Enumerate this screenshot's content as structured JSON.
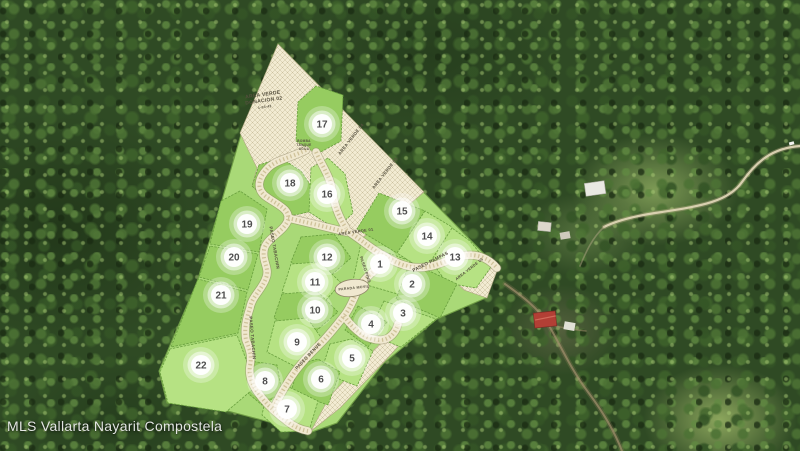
{
  "watermark": {
    "text": "MLS Vallarta Nayarit Compostela"
  },
  "map": {
    "description": "aerial-photo-with-subdivision-plat-overlay",
    "palette": {
      "lot_light": "#b6e283",
      "lot_dark": "#96cc60",
      "lot_stroke": "#69a03e",
      "hatch_cream": "#f2ebd2",
      "road_fill": "#f0e8cf",
      "road_edge": "#8f8668",
      "marker_white": "#ffffff",
      "number_gray": "#4e4e4e",
      "label_brown": "#55503e",
      "forest_green": "#2f4a24"
    },
    "lots": [
      {
        "number": "1",
        "x": 380,
        "y": 264
      },
      {
        "number": "2",
        "x": 412,
        "y": 284
      },
      {
        "number": "3",
        "x": 403,
        "y": 313
      },
      {
        "number": "4",
        "x": 371,
        "y": 324
      },
      {
        "number": "5",
        "x": 352,
        "y": 358
      },
      {
        "number": "6",
        "x": 321,
        "y": 379
      },
      {
        "number": "7",
        "x": 287,
        "y": 409
      },
      {
        "number": "8",
        "x": 265,
        "y": 381
      },
      {
        "number": "9",
        "x": 297,
        "y": 342
      },
      {
        "number": "10",
        "x": 315,
        "y": 310
      },
      {
        "number": "11",
        "x": 315,
        "y": 282
      },
      {
        "number": "12",
        "x": 327,
        "y": 257
      },
      {
        "number": "13",
        "x": 455,
        "y": 257
      },
      {
        "number": "14",
        "x": 427,
        "y": 236
      },
      {
        "number": "15",
        "x": 402,
        "y": 211
      },
      {
        "number": "16",
        "x": 327,
        "y": 194
      },
      {
        "number": "17",
        "x": 322,
        "y": 124
      },
      {
        "number": "18",
        "x": 290,
        "y": 183
      },
      {
        "number": "19",
        "x": 247,
        "y": 224
      },
      {
        "number": "20",
        "x": 234,
        "y": 257
      },
      {
        "number": "21",
        "x": 221,
        "y": 295
      },
      {
        "number": "22",
        "x": 201,
        "y": 365
      }
    ],
    "labels": [
      {
        "text": "AREA VERDE",
        "x": 263,
        "y": 96,
        "rotate": -8,
        "size": 5
      },
      {
        "text": "DONACION 02",
        "x": 264,
        "y": 102,
        "rotate": -8,
        "size": 5
      },
      {
        "text": "1-03-42",
        "x": 265,
        "y": 108,
        "rotate": -8,
        "size": 3.4
      },
      {
        "text": "AREA VERDE 04",
        "x": 352,
        "y": 140,
        "rotate": -52,
        "size": 4.4
      },
      {
        "text": "AREA VERDE 03",
        "x": 386,
        "y": 174,
        "rotate": -52,
        "size": 4.4
      },
      {
        "text": "AREA VERDE 01",
        "x": 356,
        "y": 233,
        "rotate": -8,
        "size": 4
      },
      {
        "text": "AREA VERDE 05",
        "x": 470,
        "y": 270,
        "rotate": -38,
        "size": 3.8
      },
      {
        "text": "PASEO PAMPAS",
        "x": 431,
        "y": 263,
        "rotate": -27,
        "size": 4.6
      },
      {
        "text": "PASEO TABACHIN",
        "x": 273,
        "y": 248,
        "rotate": 80,
        "size": 4.4
      },
      {
        "text": "PASEO TABACHIN",
        "x": 251,
        "y": 338,
        "rotate": 85,
        "size": 4.4
      },
      {
        "text": "PASEO BENUE",
        "x": 309,
        "y": 357,
        "rotate": -47,
        "size": 4.4
      },
      {
        "text": "PASEO PINO",
        "x": 364,
        "y": 270,
        "rotate": 72,
        "size": 4
      },
      {
        "text": "PARADA MOVIL",
        "x": 354,
        "y": 289,
        "rotate": -6,
        "size": 3.6
      },
      {
        "text": "BOMBA",
        "x": 304,
        "y": 142,
        "rotate": 0,
        "size": 3.2
      },
      {
        "text": "TANQUE",
        "x": 304,
        "y": 146,
        "rotate": 0,
        "size": 3.2
      },
      {
        "text": "AGUA",
        "x": 304,
        "y": 150,
        "rotate": 0,
        "size": 3.2
      }
    ]
  }
}
